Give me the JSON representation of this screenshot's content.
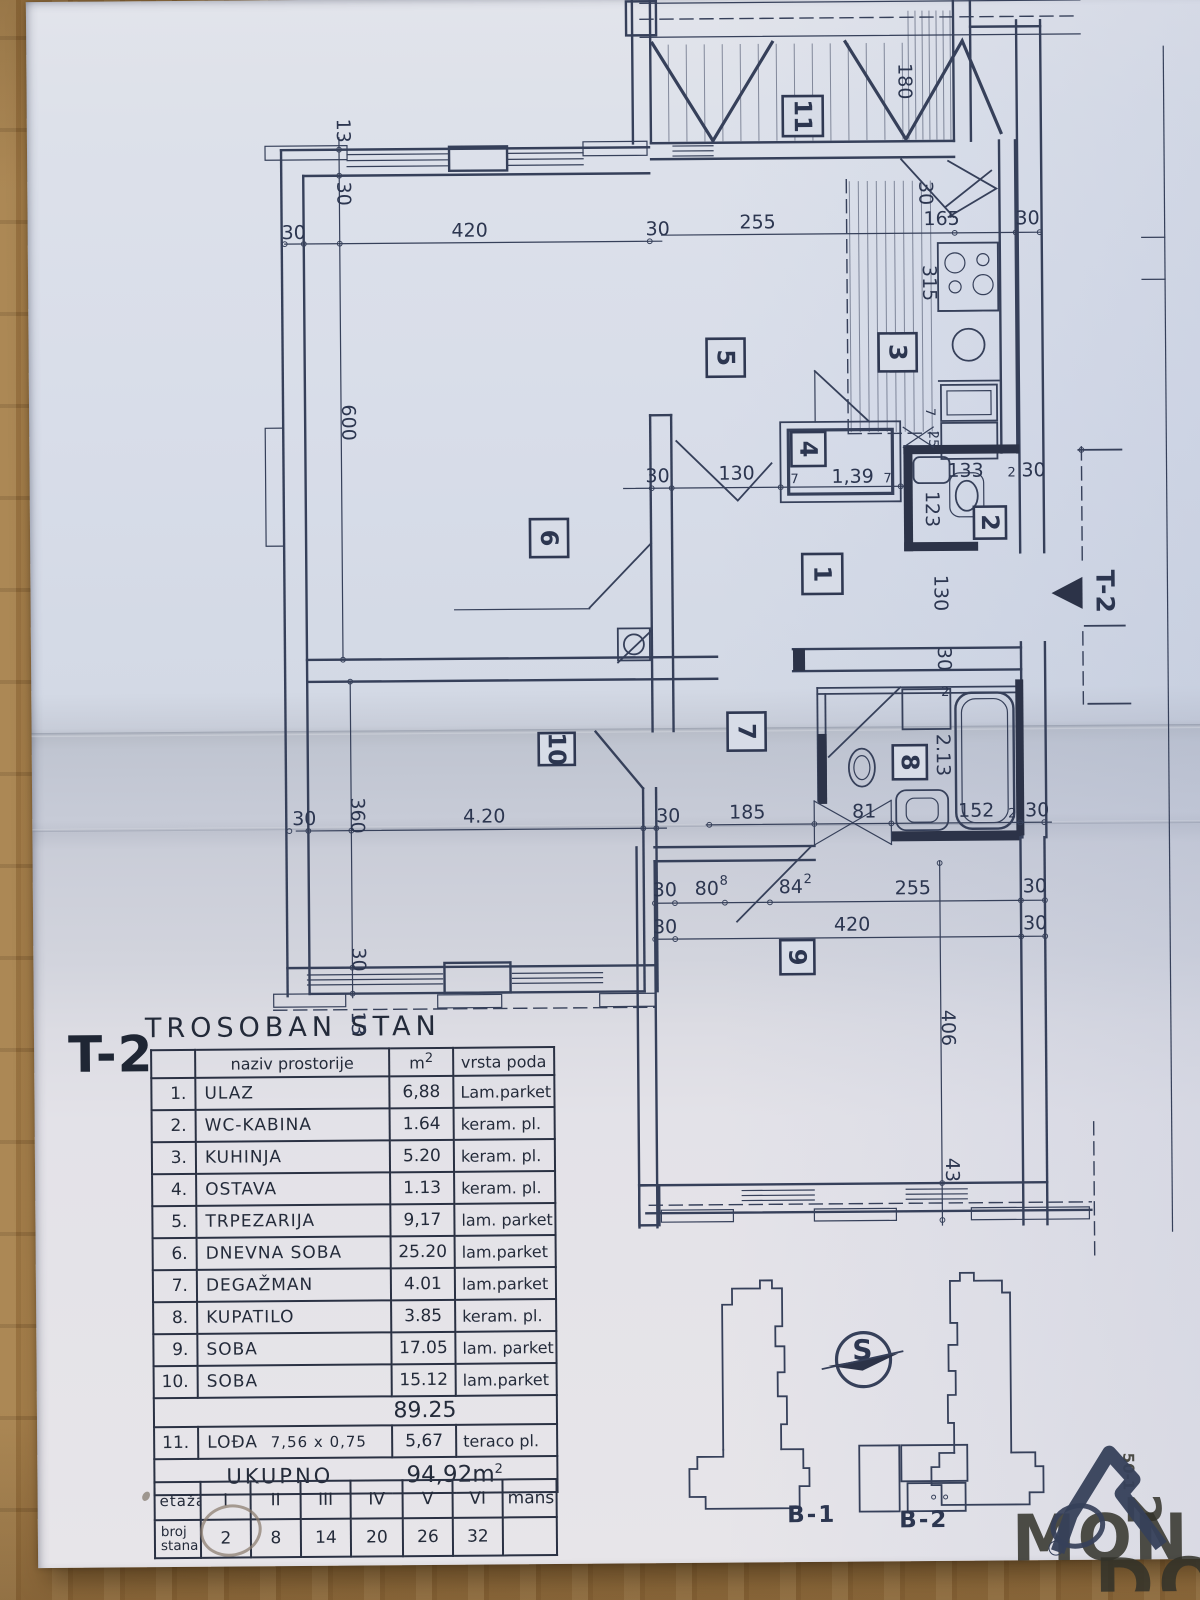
{
  "sheet": {
    "unit_label": "T-2",
    "title": "TROSOBAN STAN"
  },
  "plan": {
    "marker": "T-2",
    "rooms": {
      "r1": "1",
      "r2": "2",
      "r3": "3",
      "r4": "4",
      "r5": "5",
      "r6": "6",
      "r7": "7",
      "r8": "8",
      "r9": "9",
      "r10": "10",
      "r11": "11"
    },
    "dims": {
      "d13": "13",
      "d30": "30",
      "d420": "420",
      "d600": "600",
      "d255": "255",
      "d165": "165",
      "d180": "180",
      "d315": "315",
      "d130": "130",
      "d7": "7",
      "d25": "25",
      "d139": "1,39",
      "d133": "133",
      "d2": "2",
      "d123": "123",
      "d213": "2.13",
      "d185": "185",
      "d81": "81",
      "d152": "152",
      "d360": "360",
      "d420b": "4.20",
      "d80": "80",
      "d80sup": "8",
      "d84": "84",
      "d84sup": "2",
      "d406": "406",
      "d43": "43"
    }
  },
  "table": {
    "headers": {
      "name": "naziv prostorije",
      "area": "m",
      "area_sup": "2",
      "floor": "vrsta poda"
    },
    "rows": [
      {
        "no": "1.",
        "name": "ULAZ",
        "area": "6,88",
        "floor": "Lam.parket"
      },
      {
        "no": "2.",
        "name": "WC-KABINA",
        "area": "1.64",
        "floor": "keram. pl."
      },
      {
        "no": "3.",
        "name": "KUHINJA",
        "area": "5.20",
        "floor": "keram. pl."
      },
      {
        "no": "4.",
        "name": "OSTAVA",
        "area": "1.13",
        "floor": "keram. pl."
      },
      {
        "no": "5.",
        "name": "TRPEZARIJA",
        "area": "9,17",
        "floor": "lam. parket"
      },
      {
        "no": "6.",
        "name": "DNEVNA SOBA",
        "area": "25.20",
        "floor": "lam.parket"
      },
      {
        "no": "7.",
        "name": "DEGAŽMAN",
        "area": "4.01",
        "floor": "lam.parket"
      },
      {
        "no": "8.",
        "name": "KUPATILO",
        "area": "3.85",
        "floor": "keram. pl."
      },
      {
        "no": "9.",
        "name": "SOBA",
        "area": "17.05",
        "floor": "lam. parket"
      },
      {
        "no": "10.",
        "name": "SOBA",
        "area": "15.12",
        "floor": "lam.parket"
      }
    ],
    "subtotal": "89.25",
    "row11": {
      "no": "11.",
      "name": "LOĐA",
      "size": "7,56 x 0,75",
      "area": "5,67",
      "floor": "teraco pl."
    },
    "total_label": "UKUPNO",
    "total": "94,92m",
    "total_sup": "2"
  },
  "floors": {
    "col0": "etaža",
    "cols": [
      "I",
      "II",
      "III",
      "IV",
      "V",
      "VI",
      "mans"
    ],
    "row_label1": "broj",
    "row_label2": "stana",
    "values": [
      "2",
      "8",
      "14",
      "20",
      "26",
      "32",
      ""
    ]
  },
  "keyplan": {
    "b1": "B-1",
    "b2": "B-2",
    "compass_s": "S"
  },
  "watermark": {
    "top": "MON",
    "bottom": "DOM",
    "side_code": "50-1",
    "side_num": "2"
  }
}
